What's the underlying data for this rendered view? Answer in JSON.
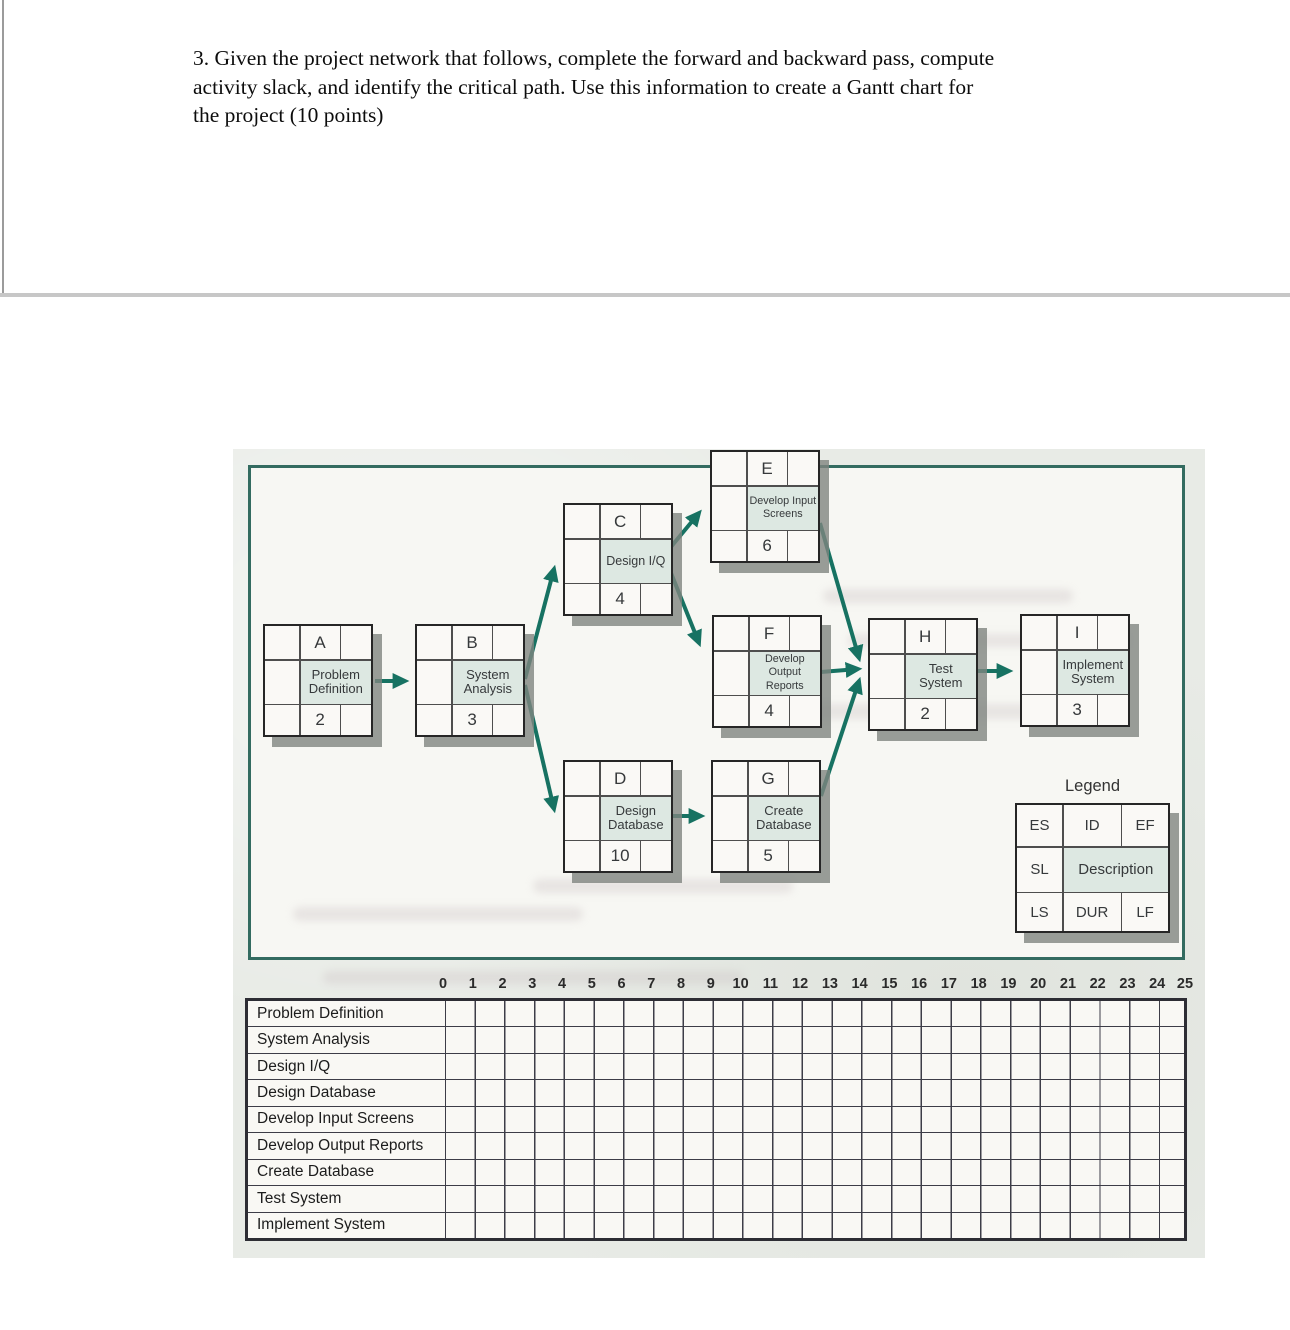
{
  "question": {
    "lines": [
      "3. Given the project network that follows, complete the forward and backward pass, compute",
      "activity slack, and identify the critical path. Use this information to create a Gantt chart for",
      "the project (10 points)"
    ]
  },
  "network": {
    "nodes": [
      {
        "id": "A",
        "description": "Problem Definition",
        "duration": "2"
      },
      {
        "id": "B",
        "description": "System Analysis",
        "duration": "3"
      },
      {
        "id": "C",
        "description": "Design I/Q",
        "duration": "4"
      },
      {
        "id": "D",
        "description": "Design Database",
        "duration": "10"
      },
      {
        "id": "E",
        "description": "Develop Input Screens",
        "duration": "6"
      },
      {
        "id": "F",
        "description": "Develop Output Reports",
        "duration": "4"
      },
      {
        "id": "G",
        "description": "Create Database",
        "duration": "5"
      },
      {
        "id": "H",
        "description": "Test System",
        "duration": "2"
      },
      {
        "id": "I",
        "description": "Implement System",
        "duration": "3"
      }
    ],
    "edges": [
      {
        "from": "A",
        "to": "B"
      },
      {
        "from": "B",
        "to": "C"
      },
      {
        "from": "B",
        "to": "D"
      },
      {
        "from": "C",
        "to": "E"
      },
      {
        "from": "C",
        "to": "F"
      },
      {
        "from": "D",
        "to": "G"
      },
      {
        "from": "E",
        "to": "H"
      },
      {
        "from": "F",
        "to": "H"
      },
      {
        "from": "G",
        "to": "H"
      },
      {
        "from": "H",
        "to": "I"
      }
    ],
    "legend": {
      "title": "Legend",
      "cells": [
        "ES",
        "ID",
        "EF",
        "SL",
        "Description",
        "LS",
        "DUR",
        "LF"
      ]
    }
  },
  "gantt": {
    "time_labels": [
      "0",
      "1",
      "2",
      "3",
      "4",
      "5",
      "6",
      "7",
      "8",
      "9",
      "10",
      "11",
      "12",
      "13",
      "14",
      "15",
      "16",
      "17",
      "18",
      "19",
      "20",
      "21",
      "22",
      "23",
      "24",
      "25"
    ],
    "rows": [
      "Problem Definition",
      "System Analysis",
      "Design I/Q",
      "Design Database",
      "Develop Input Screens",
      "Develop Output Reports",
      "Create Database",
      "Test System",
      "Implement System"
    ]
  },
  "colors": {
    "frame_teal": "#336b60",
    "arrow_teal": "#177262",
    "description_cell": "#dde8e2",
    "scan_background": "#e8ebe6",
    "grid_line": "#3d3d47"
  }
}
